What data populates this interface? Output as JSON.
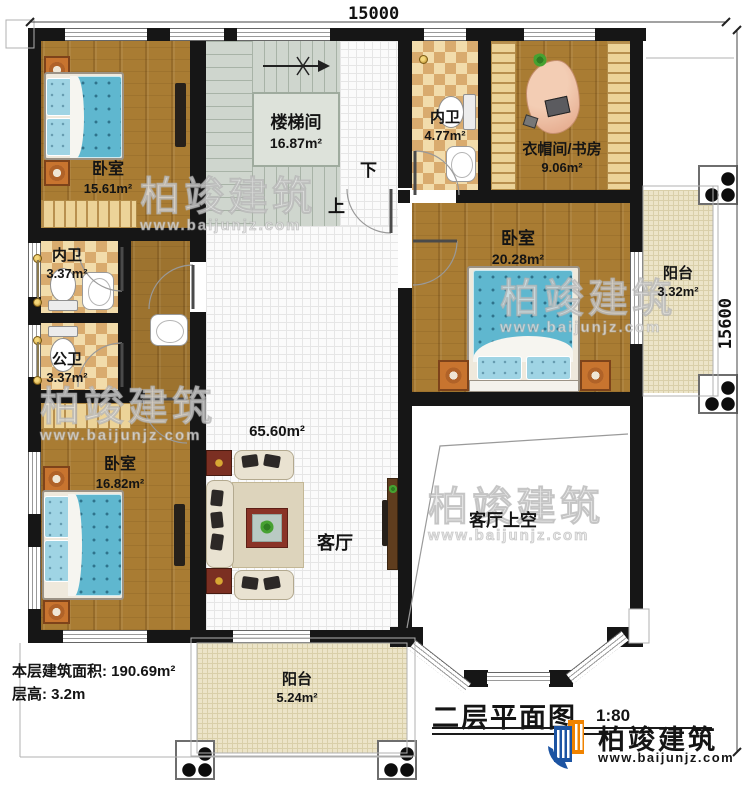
{
  "dimensions": {
    "width_top": "15000",
    "height_right": "15600"
  },
  "rooms": {
    "bedroom_top_left": {
      "name": "卧室",
      "area": "15.61m²"
    },
    "stairwell": {
      "name": "楼梯间",
      "area": "16.87m²"
    },
    "bath_ensuite_top": {
      "name": "内卫",
      "area": "4.77m²"
    },
    "cloakroom_study": {
      "name": "衣帽间/书房",
      "area": "9.06m²"
    },
    "bedroom_right": {
      "name": "卧室",
      "area": "20.28m²"
    },
    "balcony_right": {
      "name": "阳台",
      "area": "3.32m²"
    },
    "bath_ensuite_mid": {
      "name": "内卫",
      "area": "3.37m²"
    },
    "bath_public": {
      "name": "公卫",
      "area": "3.37m²"
    },
    "bedroom_bottom_left": {
      "name": "卧室",
      "area": "16.82m²"
    },
    "living_room": {
      "name": "客厅",
      "area": "65.60m²"
    },
    "living_void": {
      "name": "客厅上空"
    },
    "balcony_bottom": {
      "name": "阳台",
      "area": "5.24m²"
    }
  },
  "stairs": {
    "up": "上",
    "down": "下"
  },
  "notes": {
    "floor_area": "本层建筑面积: 190.69m²",
    "floor_height": "层高: 3.2m"
  },
  "title": {
    "text": "二层平面图",
    "scale": "1:80"
  },
  "logo": {
    "name": "柏竣建筑",
    "url": "www.baijunjz.com"
  },
  "watermark": {
    "name": "柏竣建筑",
    "url": "www.baijunjz.com"
  },
  "colors": {
    "wall": "#161616",
    "wood": "#a97c33",
    "tile_checker": "#d9ab6e",
    "stair": "#cfd6ce",
    "balcony": "#ece4c8",
    "bed": "#5fb7cf",
    "logo_blue": "#1c54a3",
    "logo_orange": "#f08300"
  }
}
